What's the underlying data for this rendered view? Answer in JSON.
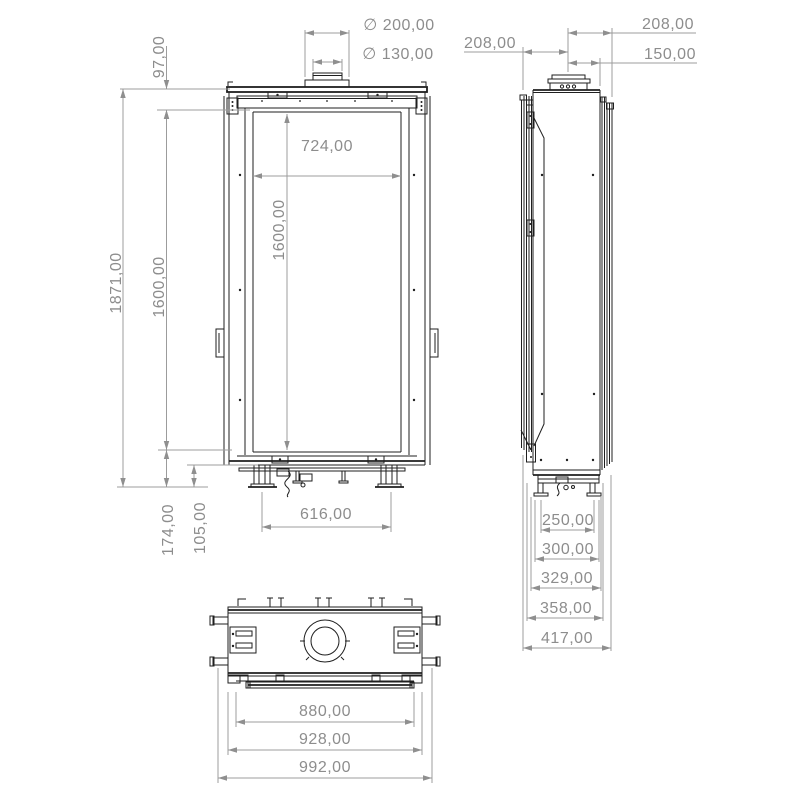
{
  "colors": {
    "linework": "#1f1f1f",
    "dimension_lines": "#9c9c9c",
    "dimension_text": "#8d8d8d",
    "background": "#ffffff"
  },
  "front_view": {
    "dims": {
      "flue_outer_diameter": "∅ 200,00",
      "flue_inner_diameter": "∅ 130,00",
      "top_section_height": "97,00",
      "overall_height": "1871,00",
      "glass_height": "1600,00",
      "glass_height_inner": "1600,00",
      "glass_width": "724,00",
      "base_section_height": "174,00",
      "foot_height": "105,00",
      "foot_spacing": "616,00"
    }
  },
  "side_view": {
    "dims": {
      "flue_center_to_front": "208,00",
      "flue_center_to_back": "208,00",
      "flue_center_to_body": "150,00",
      "foot_spacing": "250,00",
      "depth_300": "300,00",
      "depth_329": "329,00",
      "depth_358": "358,00",
      "overall_depth": "417,00"
    }
  },
  "bottom_view": {
    "dims": {
      "inner_width": "880,00",
      "frame_width": "928,00",
      "overall_width": "992,00"
    }
  }
}
